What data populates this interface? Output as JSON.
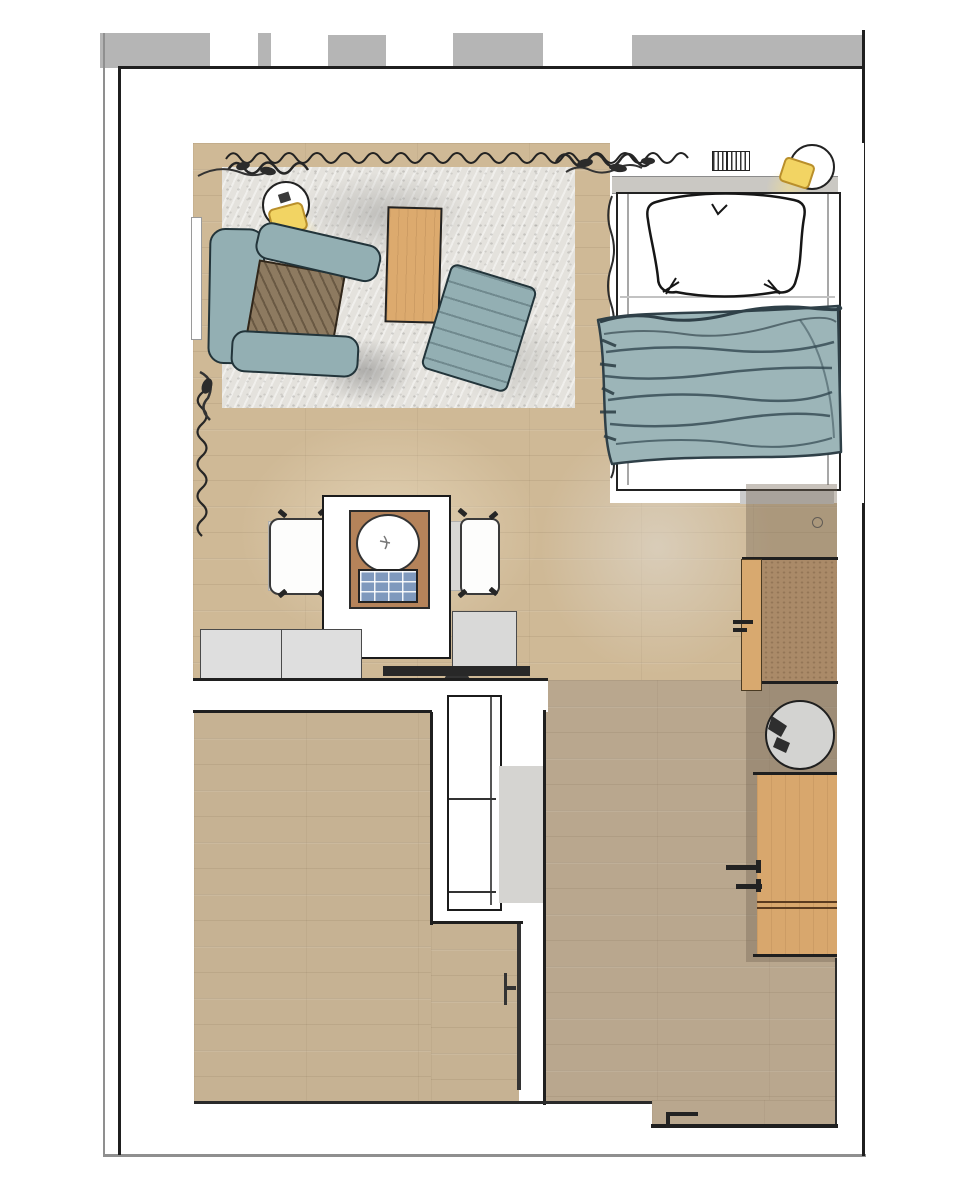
{
  "scene": {
    "type": "floor-plan",
    "view": "top-down",
    "description": "studio apartment room plan with living corner, single bed, dining counter, wall desks and lower room"
  },
  "palette": {
    "page": "#ffffff",
    "frame": "#8f8f8f",
    "wall": "#1f1f1f",
    "tab": "#b5b5b5",
    "floor_living": "#cfb996",
    "floor_room": "#c6b293",
    "floor_hall": "#b9a78e",
    "rug": "#e4e2dd",
    "teal": "#93afb3",
    "teal_dark": "#22343a",
    "blanket": "#9cb5b8",
    "blanket_line": "#324750",
    "wood_table": "#dcaa6e",
    "wood_tray": "#b5835a",
    "wood_desk": "#d8a76d",
    "cork": "#aa8a68",
    "gray_furniture": "#d8d7d4",
    "gray_cabinet": "#dedede",
    "shadow": "#cbcbcb",
    "blue_grid": "#7f99bd",
    "lamp_yellow": "#f2d463",
    "tv": "#282828"
  },
  "rooms": [
    {
      "name": "living-sleeping-area"
    },
    {
      "name": "hallway"
    },
    {
      "name": "lower-room"
    }
  ],
  "furniture": [
    "armchair",
    "ottoman",
    "coffee-table",
    "rug",
    "floor-lamp",
    "bed",
    "pillow",
    "blanket",
    "headboard-shelf",
    "wall-lamp",
    "vent",
    "dining-table",
    "dining-chair",
    "island-counter",
    "serving-tray",
    "round-plate",
    "hob-grid",
    "cabinet",
    "tv",
    "wall-shelf",
    "cork-desk",
    "desk-chair",
    "stool",
    "wood-desk",
    "door",
    "curtain",
    "window"
  ]
}
